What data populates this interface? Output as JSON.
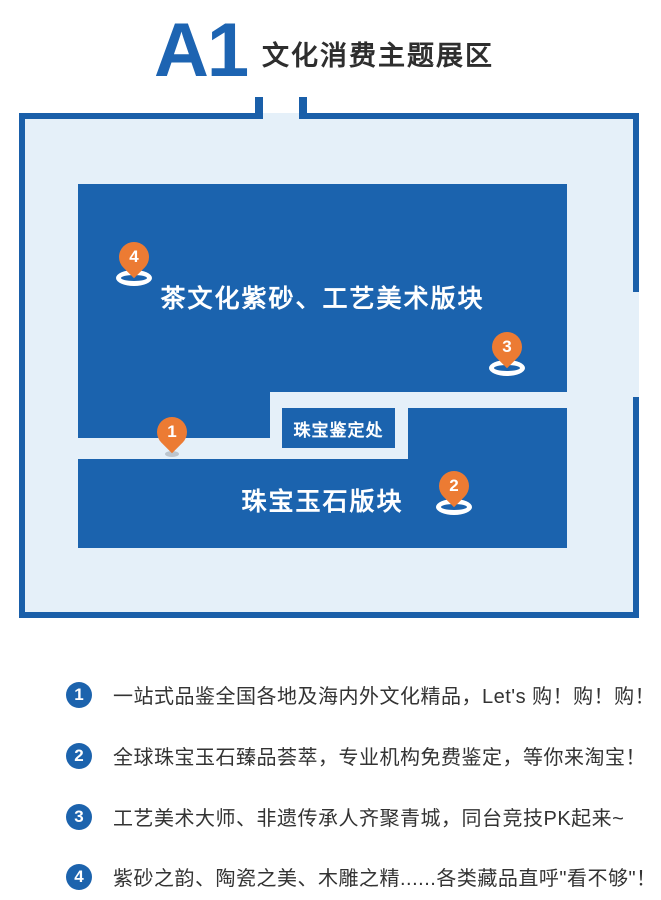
{
  "header": {
    "zone_code": "A1",
    "title": "文化消费主题展区"
  },
  "map": {
    "blocks": {
      "tea_culture": {
        "label": "茶文化紫砂、工艺美术版块"
      },
      "jewelry_appraisal": {
        "label": "珠宝鉴定处"
      },
      "jewelry_jade": {
        "label": "珠宝玉石版块"
      }
    },
    "markers": {
      "m1": {
        "number": "1"
      },
      "m2": {
        "number": "2"
      },
      "m3": {
        "number": "3"
      },
      "m4": {
        "number": "4"
      }
    }
  },
  "legend": {
    "items": [
      {
        "number": "1",
        "text": "一站式品鉴全国各地及海内外文化精品，Let's 购！购！购！"
      },
      {
        "number": "2",
        "text": "全球珠宝玉石臻品荟萃，专业机构免费鉴定，等你来淘宝！"
      },
      {
        "number": "3",
        "text": "工艺美术大师、非遗传承人齐聚青城，同台竞技PK起来~"
      },
      {
        "number": "4",
        "text": "紫砂之韵、陶瓷之美、木雕之精......各类藏品直呼\"看不够\"！"
      }
    ]
  },
  "colors": {
    "block_blue": "#1B63AE",
    "border_blue": "#1A5FA9",
    "map_fill": "#E5F0F9",
    "accent_orange": "#EC7B33",
    "zone_code_blue": "#1D64B2",
    "legend_circle_blue": "#1C63AD"
  }
}
